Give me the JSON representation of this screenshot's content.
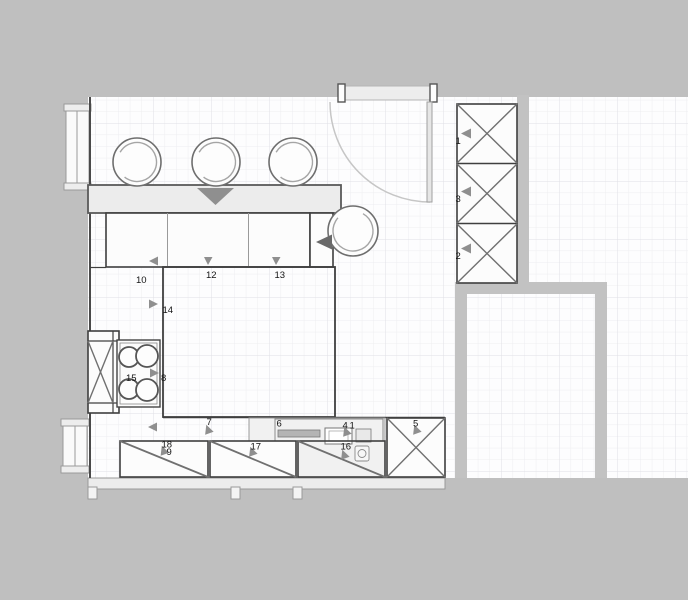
{
  "colors": {
    "bg": "#bfbfbf",
    "floor": "#fdfdfe",
    "wall": "#c2c2c2",
    "outline": "#3f3f3f",
    "xline": "#707070",
    "arrow": "#8f8f8f",
    "arrowdark": "#696969",
    "label": "#141414",
    "cabfill": "#fcfcfc",
    "lightfill": "#ececec"
  },
  "labels": [
    {
      "item": "tall-cabinet-upper",
      "text": "1"
    },
    {
      "item": "tall-cabinet-middle",
      "text": "3"
    },
    {
      "item": "tall-cabinet-lower",
      "text": "2"
    },
    {
      "item": "wall-cabinet-left",
      "text": "10"
    },
    {
      "item": "wall-cabinet-middle",
      "text": "12"
    },
    {
      "item": "wall-cabinet-right",
      "text": "13"
    },
    {
      "item": "counter-section-upper",
      "text": "14"
    },
    {
      "item": "cooktop",
      "text": "15"
    },
    {
      "item": "counter-section-lower",
      "text": "8"
    },
    {
      "item": "base-run-section",
      "text": "7"
    },
    {
      "item": "sink-run-left",
      "text": "6"
    },
    {
      "item": "sink-unit-a",
      "text": "4"
    },
    {
      "item": "sink-unit-b",
      "text": "1"
    },
    {
      "item": "corner-x-cabinet",
      "text": "5"
    },
    {
      "item": "base-cabinet-front-a",
      "text": "18"
    },
    {
      "item": "base-cabinet-front-a2",
      "text": "9"
    },
    {
      "item": "base-cabinet-front-b",
      "text": "17"
    },
    {
      "item": "base-cabinet-front-c",
      "text": "16"
    }
  ]
}
